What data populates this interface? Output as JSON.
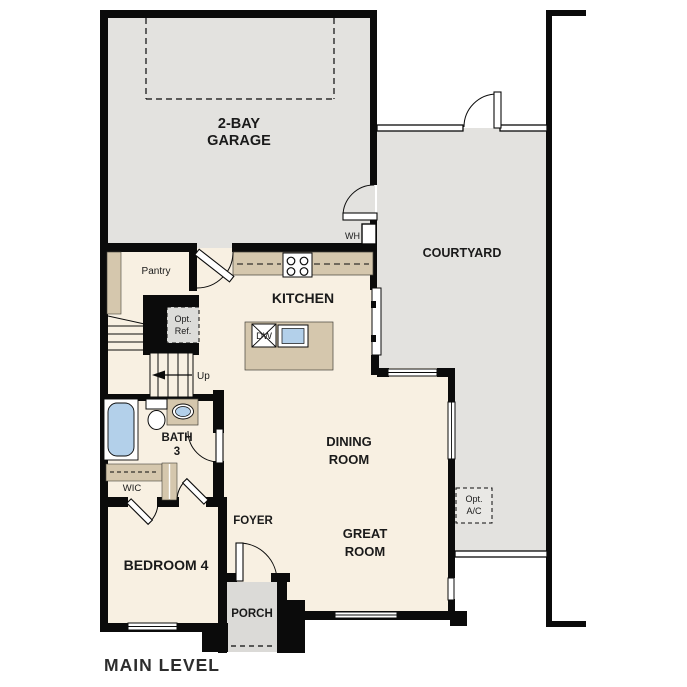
{
  "floorplan": {
    "title": "MAIN LEVEL",
    "rooms": {
      "garage": {
        "line1": "2-BAY",
        "line2": "GARAGE"
      },
      "courtyard": {
        "label": "COURTYARD"
      },
      "kitchen": {
        "label": "KITCHEN"
      },
      "dining_room": {
        "line1": "DINING",
        "line2": "ROOM"
      },
      "great_room": {
        "line1": "GREAT",
        "line2": "ROOM"
      },
      "bedroom_4": {
        "label": "BEDROOM 4"
      },
      "foyer": {
        "label": "FOYER"
      },
      "porch": {
        "label": "PORCH"
      },
      "bath_3": {
        "line1": "BATH",
        "line2": "3"
      },
      "wic": {
        "label": "WIC"
      },
      "pantry": {
        "label": "Pantry"
      }
    },
    "annotations": {
      "water_heater": "WH",
      "stairs_up": "Up",
      "dishwasher": "DW",
      "opt_ref": {
        "line1": "Opt.",
        "line2": "Ref."
      },
      "opt_ac": {
        "line1": "Opt.",
        "line2": "A/C"
      }
    },
    "colors": {
      "wall": "#0b0b0b",
      "exterior_surface": "#e3e2df",
      "interior_floor": "#f8f0e2",
      "cabinetry": "#d5c7ad",
      "plumbing_fixture": "#b3d0ea",
      "porch_surface": "#dbdad7",
      "label_text": "#1a1a1a"
    }
  }
}
